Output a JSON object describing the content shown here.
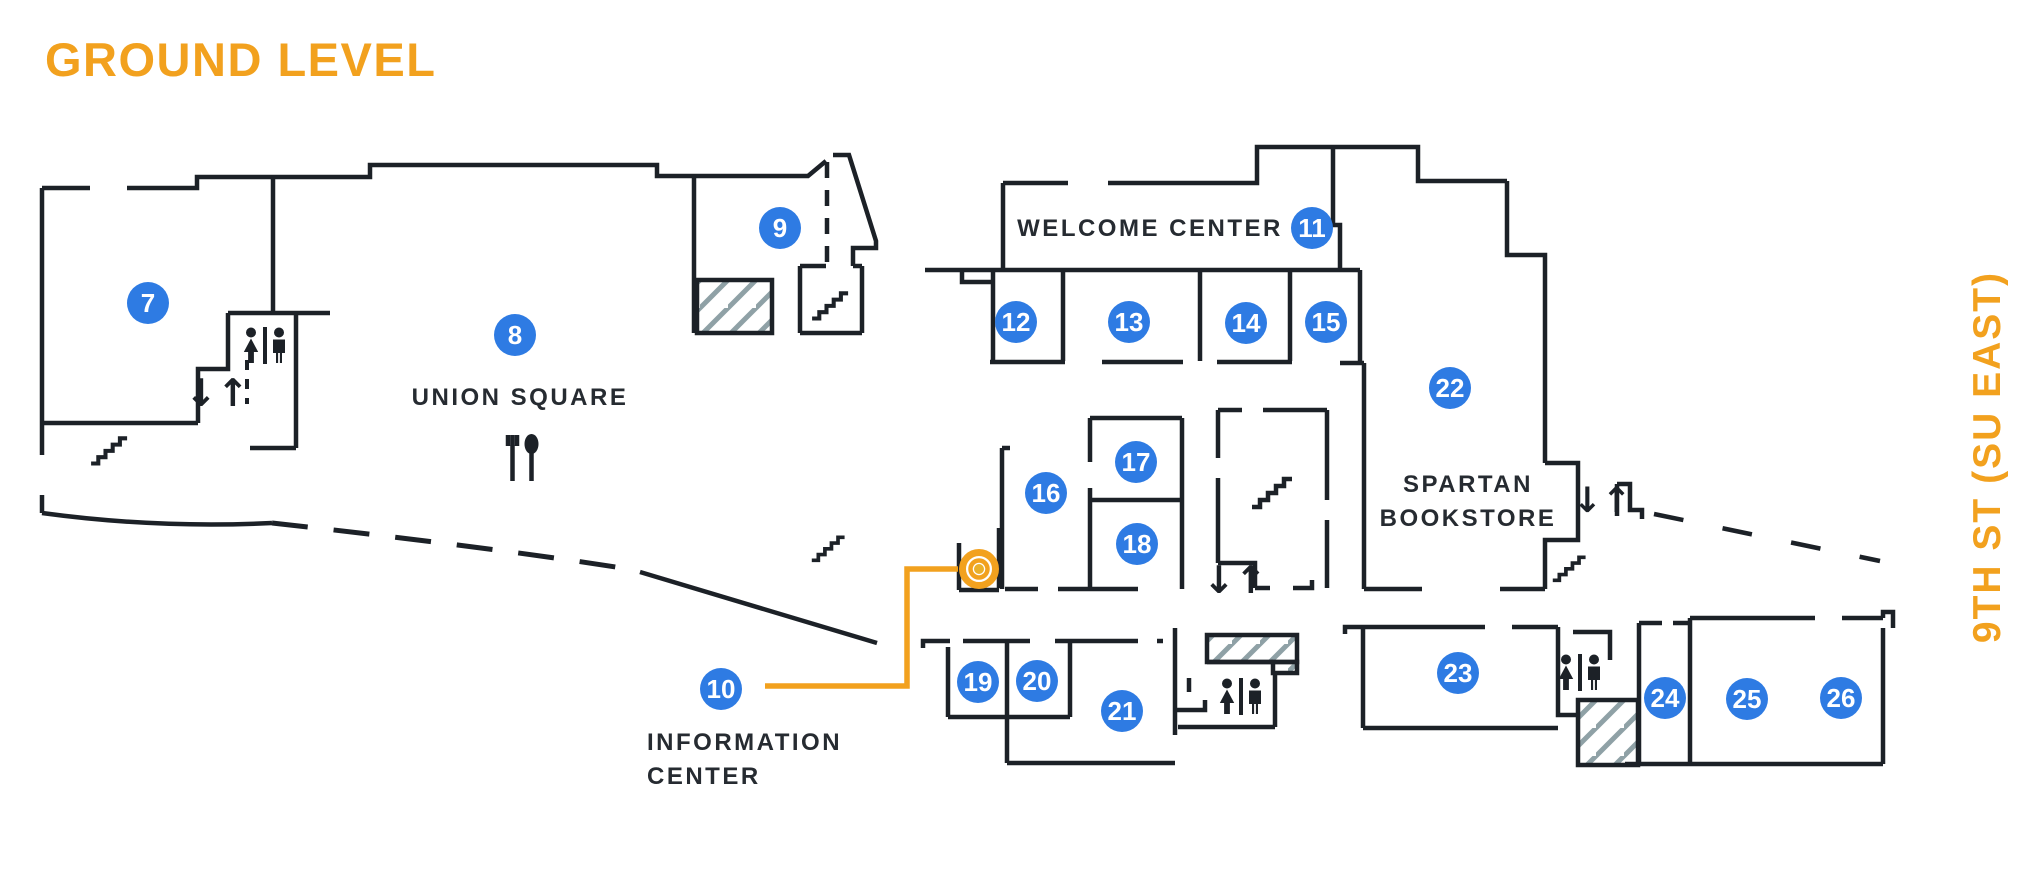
{
  "title": {
    "text": "GROUND LEVEL"
  },
  "street": {
    "text": "9TH ST (SU EAST)"
  },
  "colors": {
    "accent_orange": "#F2A11E",
    "marker_blue": "#2E7BE3",
    "wall_black": "#1C2127",
    "hatch_gray": "#8FA1A6",
    "label_dark": "#262B31",
    "bullseye_center_gold": "#E9B02C"
  },
  "area_labels": [
    {
      "id": "union-square",
      "lines": [
        "UNION SQUARE"
      ],
      "x": 520,
      "y": 405,
      "anchor": "middle"
    },
    {
      "id": "welcome-center",
      "lines": [
        "WELCOME CENTER"
      ],
      "x": 1150,
      "y": 236,
      "anchor": "middle"
    },
    {
      "id": "spartan-bookstore",
      "lines": [
        "SPARTAN",
        "BOOKSTORE"
      ],
      "x": 1468,
      "y": 492,
      "anchor": "middle"
    },
    {
      "id": "information-center",
      "lines": [
        "INFORMATION",
        "CENTER"
      ],
      "x": 647,
      "y": 750,
      "anchor": "start"
    }
  ],
  "markers": [
    {
      "n": "7",
      "x": 148,
      "y": 303
    },
    {
      "n": "8",
      "x": 515,
      "y": 335
    },
    {
      "n": "9",
      "x": 780,
      "y": 228
    },
    {
      "n": "10",
      "x": 721,
      "y": 689
    },
    {
      "n": "11",
      "x": 1312,
      "y": 228
    },
    {
      "n": "12",
      "x": 1016,
      "y": 322
    },
    {
      "n": "13",
      "x": 1129,
      "y": 322
    },
    {
      "n": "14",
      "x": 1246,
      "y": 323
    },
    {
      "n": "15",
      "x": 1326,
      "y": 322
    },
    {
      "n": "16",
      "x": 1046,
      "y": 493
    },
    {
      "n": "17",
      "x": 1136,
      "y": 462
    },
    {
      "n": "18",
      "x": 1137,
      "y": 544
    },
    {
      "n": "19",
      "x": 978,
      "y": 682
    },
    {
      "n": "20",
      "x": 1037,
      "y": 681
    },
    {
      "n": "21",
      "x": 1122,
      "y": 711
    },
    {
      "n": "22",
      "x": 1450,
      "y": 388
    },
    {
      "n": "23",
      "x": 1458,
      "y": 673
    },
    {
      "n": "24",
      "x": 1665,
      "y": 698
    },
    {
      "n": "25",
      "x": 1747,
      "y": 699
    },
    {
      "n": "26",
      "x": 1841,
      "y": 698
    }
  ],
  "icons": [
    {
      "type": "restroom",
      "name": "restroom-icon",
      "x": 265,
      "y": 346,
      "s": 1
    },
    {
      "type": "restroom",
      "name": "restroom-icon",
      "x": 1241,
      "y": 697,
      "s": 1
    },
    {
      "type": "restroom",
      "name": "restroom-icon",
      "x": 1580,
      "y": 673,
      "s": 1
    },
    {
      "type": "elevator",
      "name": "elevator-icon",
      "x": 217,
      "y": 393,
      "s": 1
    },
    {
      "type": "elevator",
      "name": "elevator-icon",
      "x": 1235,
      "y": 580,
      "s": 1
    },
    {
      "type": "elevator",
      "name": "elevator-icon",
      "x": 1602,
      "y": 500,
      "s": 0.92
    },
    {
      "type": "stairs",
      "name": "stairs-icon",
      "x": 110,
      "y": 450,
      "s": 0.9
    },
    {
      "type": "stairs",
      "name": "stairs-icon",
      "x": 831,
      "y": 305,
      "s": 0.9
    },
    {
      "type": "stairs",
      "name": "stairs-icon",
      "x": 829,
      "y": 548,
      "s": 0.82
    },
    {
      "type": "stairs",
      "name": "stairs-icon",
      "x": 1273,
      "y": 492,
      "s": 1.0
    },
    {
      "type": "stairs",
      "name": "stairs-icon",
      "x": 1570,
      "y": 568,
      "s": 0.82
    },
    {
      "type": "food",
      "name": "dining-icon",
      "x": 522,
      "y": 458,
      "s": 1
    }
  ],
  "route": {
    "points": [
      [
        765,
        686
      ],
      [
        907,
        686
      ],
      [
        907,
        569
      ],
      [
        958,
        569
      ]
    ],
    "bullseye": {
      "x": 979,
      "y": 569
    },
    "links_marker": "10"
  }
}
